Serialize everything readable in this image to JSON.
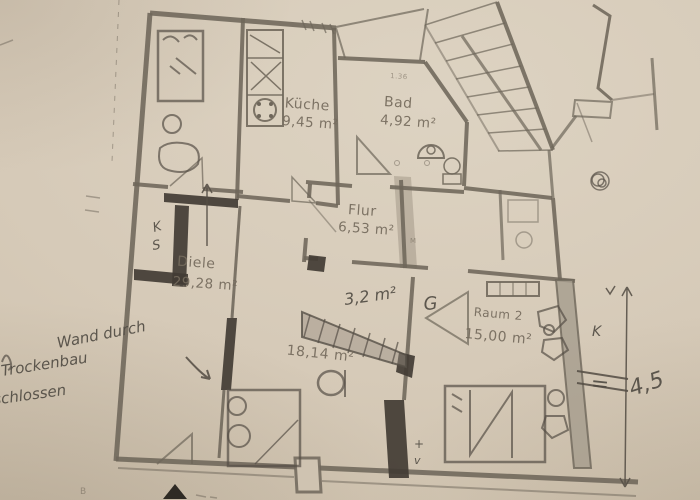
{
  "photo": {
    "description_colors": {
      "paper_color": "#d6cab8",
      "print_line_color": "#6e665a",
      "pencil_color": "#554f46",
      "highlighter_color": "#9b9285"
    }
  },
  "rooms": {
    "kueche": {
      "name": "Küche",
      "area": "9,45 m²"
    },
    "bad": {
      "name": "Bad",
      "area": "4,92 m²"
    },
    "flur": {
      "name": "Flur",
      "area": "6,53 m²"
    },
    "diele": {
      "name": "Diele",
      "area": "29,28 m²"
    },
    "zimmer": {
      "area": "18,14 m²"
    },
    "raum2": {
      "name": "Raum 2",
      "area": "15,00 m²"
    }
  },
  "printed_marks": {
    "bad_dimension": "1.36",
    "flur_mark": "M",
    "bottom_left": "B"
  },
  "handwriting": {
    "note_line1": "Wand durch",
    "note_line2": "Trockenbau",
    "note_line3": "schlossen",
    "small_area": "3,2 m²",
    "door_letter": "G",
    "closet_letter_k": "K",
    "closet_letter_s": "S",
    "right_letter_k": "K",
    "equals_sign": "=",
    "dimension_value": "4,5",
    "plus_mark": "+",
    "check_mark": "v"
  }
}
